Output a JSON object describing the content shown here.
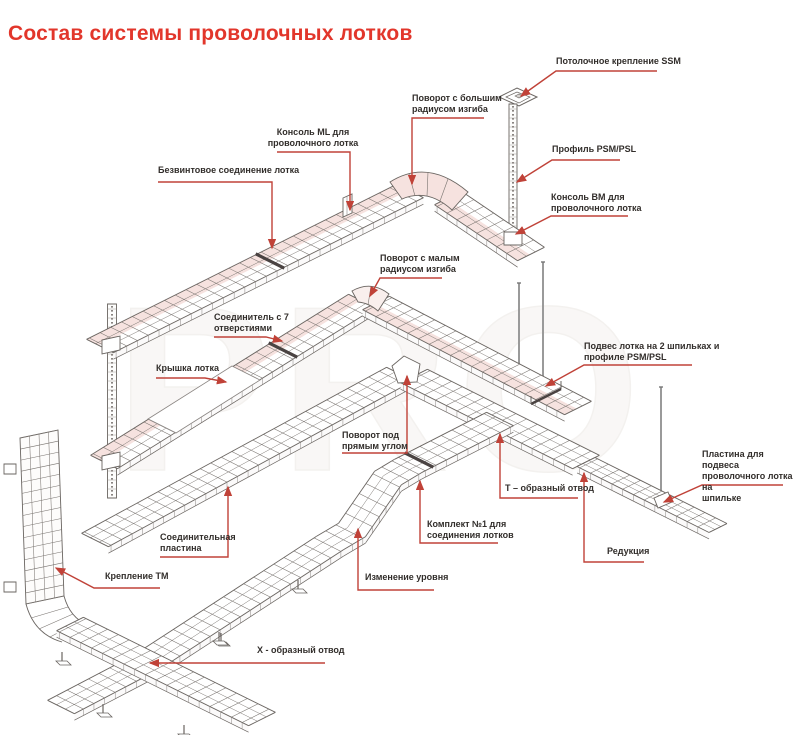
{
  "title": {
    "text": "Состав системы проволочных лотков"
  },
  "watermark": "PRO",
  "colors": {
    "title": "#e2362b",
    "leader": "#c04238",
    "label_text": "#322e2b",
    "tray_line": "#6a6561",
    "tray_tint": "#f6e2df"
  },
  "labels": [
    {
      "id": "ssm",
      "text": "Потолочное крепление SSM",
      "x": 556,
      "y": 56,
      "align": "left",
      "leader": [
        [
          657,
          71
        ],
        [
          556,
          71
        ],
        [
          521,
          96
        ]
      ]
    },
    {
      "id": "big-radius",
      "text": "Поворот с большим\nрадиусом изгиба",
      "x": 412,
      "y": 93,
      "align": "left",
      "leader": [
        [
          484,
          118
        ],
        [
          412,
          118
        ],
        [
          412,
          184
        ]
      ]
    },
    {
      "id": "psm-profile",
      "text": "Профиль PSM/PSL",
      "x": 552,
      "y": 144,
      "align": "left",
      "leader": [
        [
          620,
          160
        ],
        [
          552,
          160
        ],
        [
          517,
          182
        ]
      ]
    },
    {
      "id": "bm-console",
      "text": "Консоль BM для\nпроволочного лотка",
      "x": 551,
      "y": 192,
      "align": "left",
      "leader": [
        [
          628,
          216
        ],
        [
          551,
          216
        ],
        [
          516,
          234
        ]
      ]
    },
    {
      "id": "ml-console",
      "text": "Консоль ML для\nпроволочного лотка",
      "x": 313,
      "y": 127,
      "align": "center",
      "leader": [
        [
          277,
          152
        ],
        [
          350,
          152
        ],
        [
          350,
          210
        ]
      ]
    },
    {
      "id": "screwless",
      "text": "Безвинтовое соединение лотка",
      "x": 158,
      "y": 165,
      "align": "left",
      "leader": [
        [
          158,
          182
        ],
        [
          272,
          182
        ],
        [
          272,
          248
        ]
      ]
    },
    {
      "id": "small-radius",
      "text": "Поворот с малым\nрадиусом изгиба",
      "x": 380,
      "y": 253,
      "align": "left",
      "leader": [
        [
          442,
          278
        ],
        [
          380,
          278
        ],
        [
          370,
          296
        ]
      ]
    },
    {
      "id": "connector7",
      "text": "Соединитель с 7\nотверстиями",
      "x": 214,
      "y": 312,
      "align": "left",
      "leader": [
        [
          214,
          337
        ],
        [
          266,
          337
        ],
        [
          282,
          341
        ]
      ]
    },
    {
      "id": "cover",
      "text": "Крышка лотка",
      "x": 156,
      "y": 363,
      "align": "left",
      "leader": [
        [
          156,
          378
        ],
        [
          205,
          378
        ],
        [
          226,
          382
        ]
      ]
    },
    {
      "id": "right-angle",
      "text": "Поворот под\nпрямым углом",
      "x": 342,
      "y": 430,
      "align": "left",
      "leader": [
        [
          342,
          453
        ],
        [
          407,
          453
        ],
        [
          407,
          376
        ]
      ]
    },
    {
      "id": "suspension2",
      "text": "Подвес лотка на 2 шпильках и\nпрофиле PSM/PSL",
      "x": 584,
      "y": 341,
      "align": "left",
      "leader": [
        [
          692,
          365
        ],
        [
          584,
          365
        ],
        [
          546,
          386
        ]
      ]
    },
    {
      "id": "plate-stud",
      "text": "Пластина для подвеса\nпроволочного лотка на\nшпильке",
      "x": 702,
      "y": 449,
      "align": "left",
      "leader": [
        [
          783,
          485
        ],
        [
          702,
          485
        ],
        [
          664,
          502
        ]
      ]
    },
    {
      "id": "t-branch",
      "text": "Т – образный отвод",
      "x": 505,
      "y": 483,
      "align": "left",
      "leader": [
        [
          578,
          498
        ],
        [
          500,
          498
        ],
        [
          500,
          434
        ]
      ]
    },
    {
      "id": "kit1",
      "text": "Комплект №1 для\nсоединения лотков",
      "x": 427,
      "y": 519,
      "align": "left",
      "leader": [
        [
          498,
          543
        ],
        [
          420,
          543
        ],
        [
          420,
          481
        ]
      ]
    },
    {
      "id": "reduction",
      "text": "Редукция",
      "x": 607,
      "y": 546,
      "align": "left",
      "leader": [
        [
          644,
          562
        ],
        [
          584,
          562
        ],
        [
          584,
          473
        ]
      ]
    },
    {
      "id": "level-change",
      "text": "Изменение уровня",
      "x": 365,
      "y": 572,
      "align": "left",
      "leader": [
        [
          434,
          590
        ],
        [
          358,
          590
        ],
        [
          358,
          529
        ]
      ]
    },
    {
      "id": "join-plate",
      "text": "Соединительная\nпластина",
      "x": 160,
      "y": 532,
      "align": "left",
      "leader": [
        [
          160,
          557
        ],
        [
          228,
          557
        ],
        [
          228,
          487
        ]
      ]
    },
    {
      "id": "tm-fix",
      "text": "Крепление TM",
      "x": 105,
      "y": 571,
      "align": "left",
      "leader": [
        [
          160,
          588
        ],
        [
          94,
          588
        ],
        [
          56,
          568
        ]
      ]
    },
    {
      "id": "x-branch",
      "text": "X - образный отвод",
      "x": 257,
      "y": 645,
      "align": "left",
      "leader": [
        [
          325,
          663
        ],
        [
          150,
          663
        ]
      ]
    }
  ]
}
